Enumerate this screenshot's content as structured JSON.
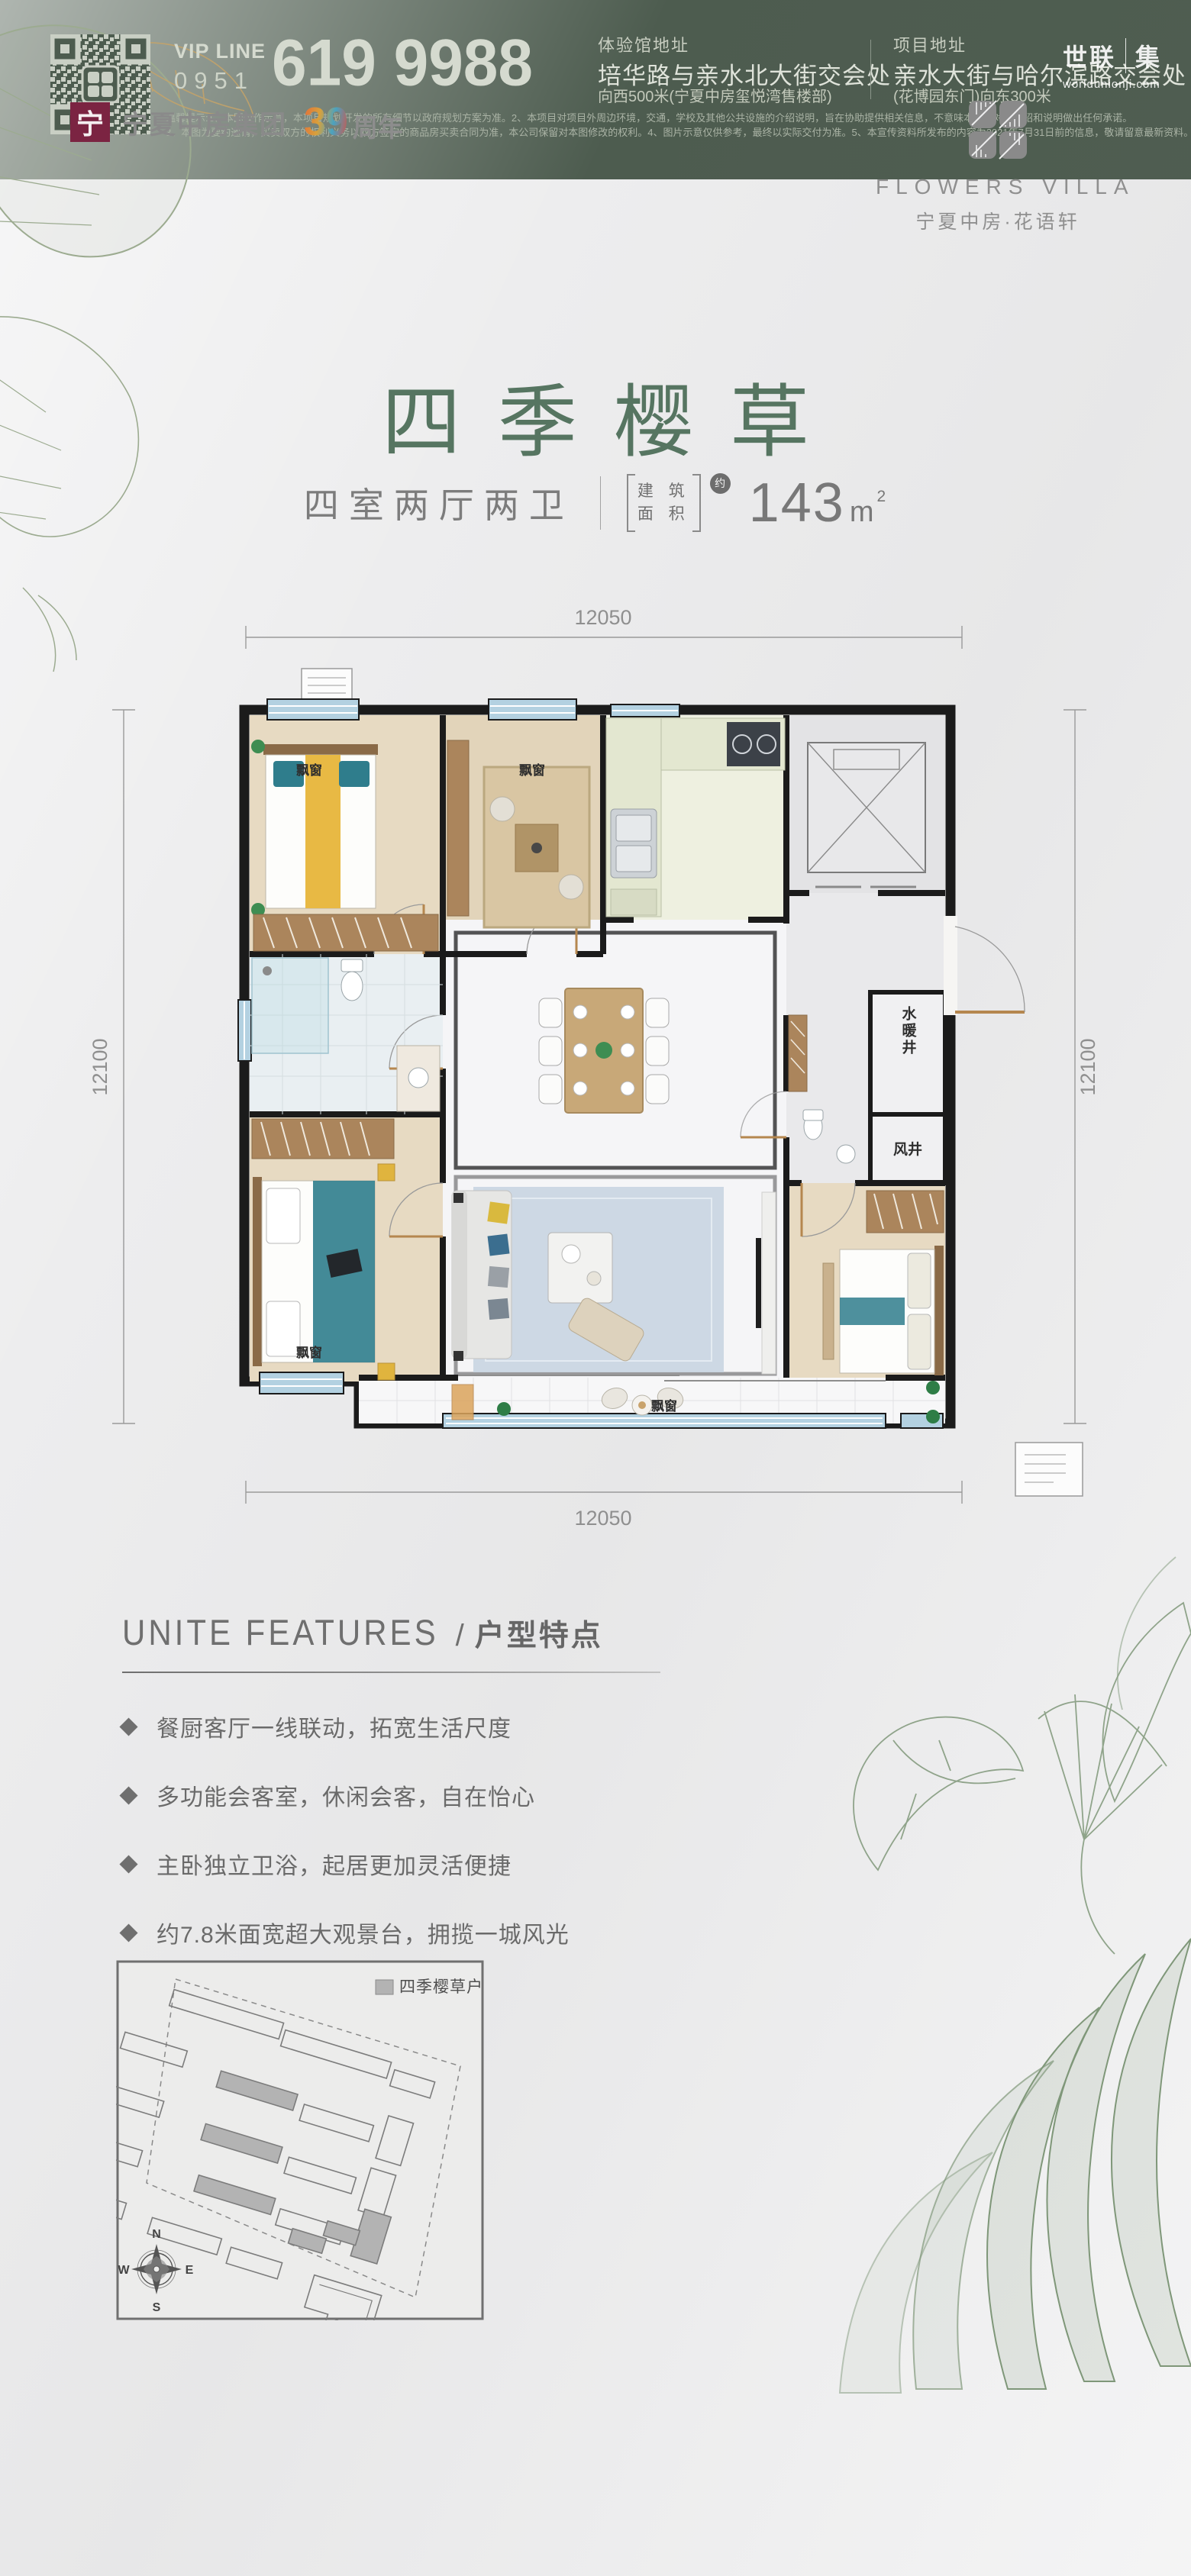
{
  "watermark": {
    "part1": "世联",
    "part2": "集",
    "url": "worldunionji.com"
  },
  "header": {
    "brand": {
      "logo_char": "宁",
      "name": "宁夏中房集团",
      "anniversary_number": "39",
      "anniversary_label": "周年"
    },
    "project": {
      "name_en": "FLOWERS VILLA",
      "name_cn": "宁夏中房·花语轩"
    }
  },
  "hero": {
    "title": "四季樱草",
    "layout": "四室两厅两卫",
    "area_label_line1": "建 筑",
    "area_label_line2": "面 积",
    "area_approx": "约",
    "area_value": "143",
    "area_unit": "m",
    "area_sup": "2"
  },
  "floorplan": {
    "dim_top": "12050",
    "dim_bottom": "12050",
    "dim_left": "12100",
    "dim_right": "12100",
    "labels": {
      "bay_window": "飘窗",
      "water_shaft": "水暖井",
      "air_shaft": "风井"
    }
  },
  "features": {
    "title_en": "UNITE FEATURES",
    "separator": "/",
    "title_cn": "户型特点",
    "items": [
      "餐厨客厅一线联动，拓宽生活尺度",
      "多功能会客室，休闲会客，自在怡心",
      "主卧独立卫浴，起居更加灵活便捷",
      "约7.8米面宽超大观景台，拥揽一城风光"
    ]
  },
  "siteplan": {
    "legend": "四季樱草户型",
    "compass": {
      "n": "N",
      "e": "E",
      "s": "S",
      "w": "W"
    }
  },
  "footer": {
    "vip_label": "VIP LINE",
    "vip_area_code": "0951",
    "vip_number": "619 9988",
    "experience_hall": {
      "label": "体验馆地址",
      "line1": "培华路与亲水北大街交会处",
      "line2": "向西500米(宁夏中房玺悦湾售楼部)"
    },
    "project_address": {
      "label": "项目地址",
      "line1": "亲水大街与哈尔滨路交会处",
      "line2": "(花博园东门)向东300米"
    },
    "disclaimer_line1": "温馨提示:1、本图仅作示意，本项目规划开发的所有细节以政府规划方案为准。2、本项目对项目外周边环境，交通，学校及其他公共设施的介绍说明，旨在协助提供相关信息，不意味本公司对此介绍和说明做出任何承诺。",
    "disclaimer_line2": "3、本图为要约邀请，买卖双方的权利义务以双方签定的商品房买卖合同为准，本公司保留对本图修改的权利。4、图片示意仅供参考，最终以实际交付为准。5、本宣传资料所发布的内容为2021年7月31日前的信息，敬请留意最新资料。"
  },
  "colors": {
    "title_green": "#567561",
    "footer_bg": "#4d5c4f",
    "brand_red": "#7b2442",
    "window_blue": "#b3d1e1",
    "accent_teal": "#2f7d8c",
    "accent_yellow": "#e8b944"
  }
}
